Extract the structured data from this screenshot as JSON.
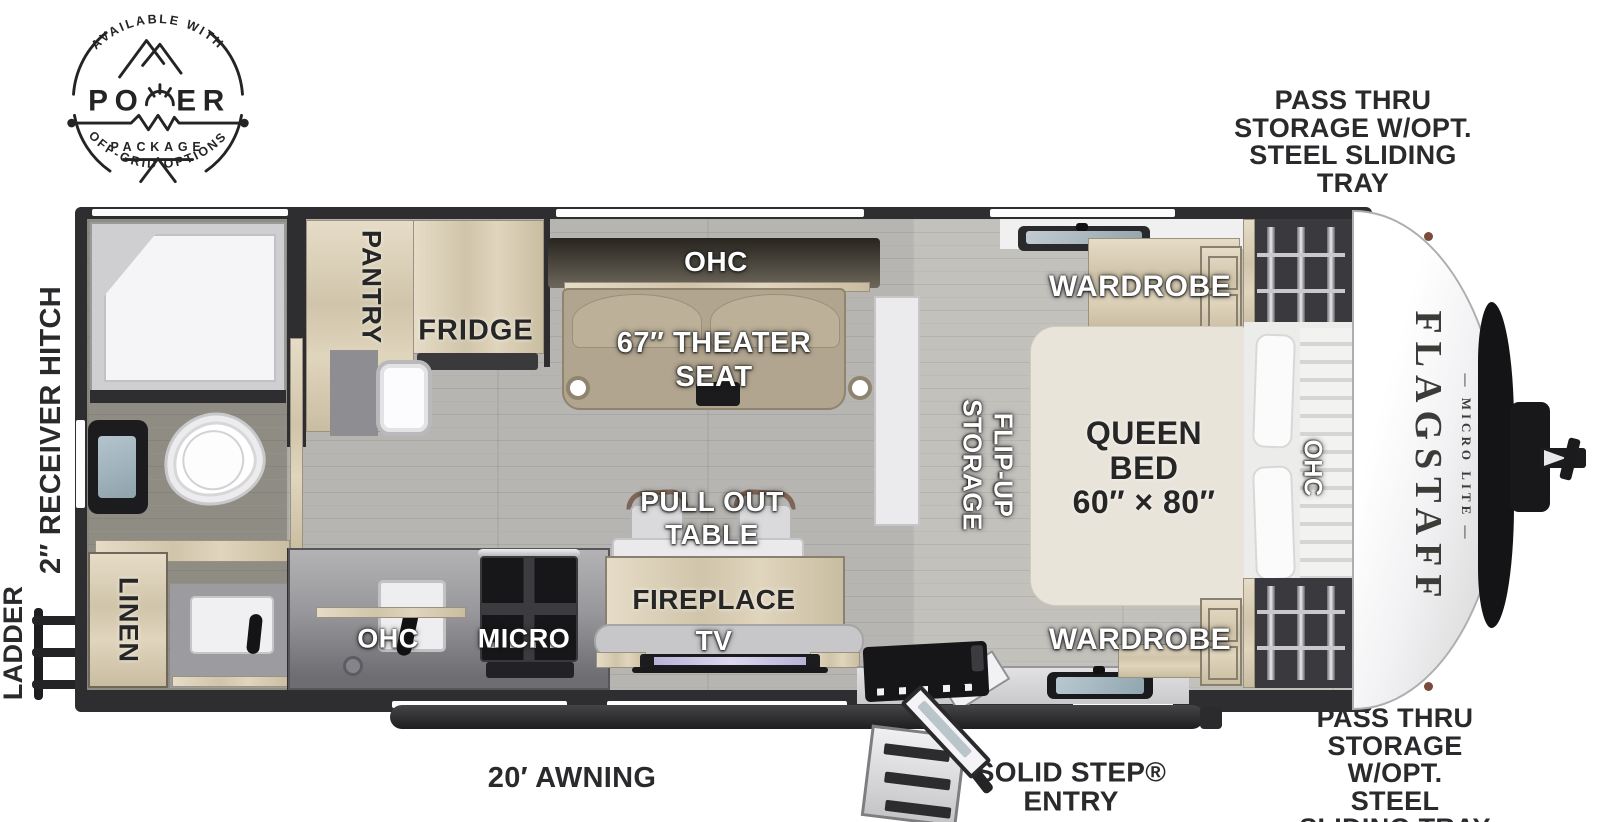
{
  "colors": {
    "wall": "#2e2e30",
    "wood": "#d9cfba",
    "floor": "#b7b5b1",
    "seat_tan": "#b2a58f",
    "label_white": "#ffffff",
    "label_dark": "#262626"
  },
  "badge": {
    "arc_top": "AVAILABLE WITH",
    "po": "PO",
    "er": "ER",
    "package": "PACKAGE",
    "arc_bottom": "OFF-GRID OPTIONS"
  },
  "brand": {
    "name": "FLAGSTAFF",
    "sub": "— MICRO LITE —"
  },
  "annotations": {
    "pass_thru_top": [
      "PASS THRU",
      "STORAGE W/OPT.",
      "STEEL SLIDING TRAY"
    ],
    "pass_thru_bottom": [
      "PASS THRU",
      "STORAGE W/OPT.",
      "STEEL SLIDING TRAY"
    ],
    "receiver_hitch": "2″ RECEIVER HITCH",
    "ladder": "LADDER",
    "awning": "20′ AWNING",
    "entry": [
      "SOLID STEP®",
      "ENTRY"
    ]
  },
  "labels": {
    "pantry": "PANTRY",
    "fridge": "FRIDGE",
    "ohc_living": "OHC",
    "theater": [
      "67″ THEATER",
      "SEAT"
    ],
    "wardrobe_top": "WARDROBE",
    "wardrobe_bottom": "WARDROBE",
    "flip_up": [
      "FLIP-UP",
      "STORAGE"
    ],
    "queen_bed": [
      "QUEEN",
      "BED",
      "60″ × 80″"
    ],
    "ohc_bed": "OHC",
    "pull_out": [
      "PULL OUT",
      "TABLE"
    ],
    "fireplace": "FIREPLACE",
    "tv": "TV",
    "ohc_kitchen": "OHC",
    "micro": "MICRO",
    "linen": "LINEN"
  }
}
